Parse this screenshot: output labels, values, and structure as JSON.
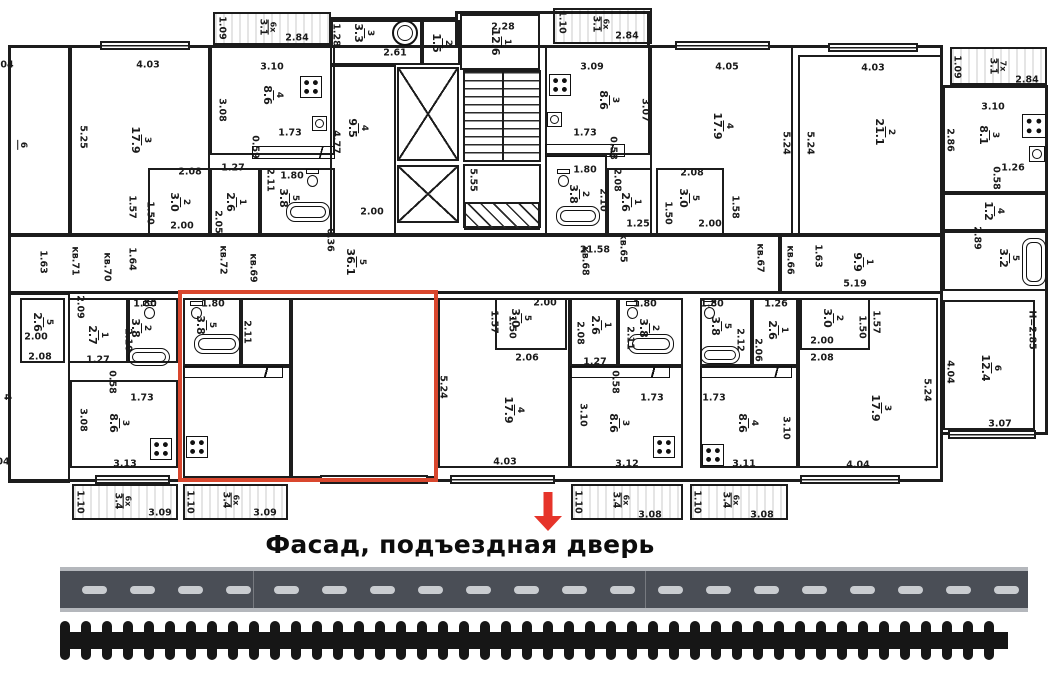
{
  "caption": {
    "text": "Фасад, подъездная дверь"
  },
  "colors": {
    "wall": "#1c1c1c",
    "highlight": "#d9472e",
    "arrow": "#e6342a",
    "road_bg": "#4a4e56",
    "road_edge": "#b4b7bc",
    "road_dash": "#c9ccd0",
    "rail": "#161616"
  },
  "plan": {
    "rooms": [
      [
        8,
        45,
        62,
        190,
        "6",
        "",
        22,
        145
      ],
      [
        70,
        45,
        140,
        190,
        "3",
        "17.9"
      ],
      [
        210,
        45,
        125,
        110,
        "4",
        "8.6",
        272,
        95
      ],
      [
        148,
        168,
        62,
        67,
        "2",
        "3.0"
      ],
      [
        210,
        168,
        50,
        67,
        "1",
        "2.6"
      ],
      [
        260,
        168,
        75,
        67,
        "5",
        "3.8",
        288,
        198
      ],
      [
        330,
        20,
        92,
        45,
        "3",
        "3.3",
        363,
        33
      ],
      [
        422,
        20,
        38,
        45,
        "2",
        "1.5"
      ],
      [
        330,
        65,
        66,
        170,
        "4",
        "9.5",
        357,
        128
      ],
      [
        460,
        14,
        80,
        56,
        "1",
        "12.6",
        500,
        42
      ],
      [
        545,
        45,
        105,
        110,
        "3",
        "8.6",
        608,
        100
      ],
      [
        545,
        155,
        62,
        80,
        "2",
        "3.8",
        578,
        194
      ],
      [
        607,
        168,
        45,
        67,
        "1",
        "2.6"
      ],
      [
        656,
        168,
        68,
        67,
        "5",
        "3.0",
        688,
        198
      ],
      [
        650,
        45,
        143,
        190,
        "4",
        "17.9",
        722,
        126
      ],
      [
        798,
        55,
        145,
        180,
        "2",
        "21.1",
        884,
        132
      ],
      [
        943,
        85,
        105,
        108,
        "3",
        "8.1",
        988,
        135
      ],
      [
        943,
        193,
        105,
        38,
        "4",
        "1.2",
        993,
        211
      ],
      [
        943,
        231,
        105,
        60,
        "5",
        "3.2",
        1008,
        258
      ],
      [
        8,
        235,
        772,
        58,
        "5",
        "36.1",
        355,
        262
      ],
      [
        780,
        235,
        163,
        58,
        "1",
        "9.9",
        862,
        262
      ],
      [
        8,
        293,
        62,
        190,
        "",
        ""
      ],
      [
        20,
        298,
        45,
        65,
        "5",
        "2.6",
        42,
        322
      ],
      [
        68,
        298,
        60,
        65,
        "1",
        "2.7",
        97,
        335
      ],
      [
        128,
        298,
        50,
        65,
        "2",
        "3.8",
        140,
        328
      ],
      [
        70,
        380,
        108,
        88,
        "3",
        "8.6",
        118,
        423
      ],
      [
        183,
        298,
        58,
        68,
        "5",
        "3.8",
        205,
        325
      ],
      [
        241,
        298,
        50,
        68,
        "",
        ""
      ],
      [
        183,
        366,
        108,
        112,
        "",
        ""
      ],
      [
        291,
        298,
        145,
        180,
        "",
        ""
      ],
      [
        438,
        298,
        132,
        170,
        "4",
        "17.9",
        513,
        410
      ],
      [
        495,
        298,
        72,
        52,
        "5",
        "3.0",
        520,
        318
      ],
      [
        570,
        298,
        48,
        68,
        "1",
        "2.6",
        600,
        325
      ],
      [
        618,
        298,
        65,
        68,
        "2",
        "3.8",
        648,
        328
      ],
      [
        570,
        366,
        113,
        102,
        "3",
        "8.6",
        618,
        423
      ],
      [
        700,
        298,
        52,
        68,
        "5",
        "3.8",
        720,
        326
      ],
      [
        752,
        298,
        46,
        68,
        "1",
        "2.6",
        777,
        330
      ],
      [
        800,
        298,
        70,
        52,
        "2",
        "3.0",
        832,
        318
      ],
      [
        700,
        366,
        98,
        102,
        "4",
        "8.6",
        747,
        423
      ],
      [
        798,
        298,
        140,
        170,
        "3",
        "17.9",
        880,
        408
      ],
      [
        943,
        300,
        92,
        130,
        "6",
        "12.4",
        990,
        368
      ]
    ],
    "balconies": [
      [
        213,
        12,
        118,
        33,
        "6x",
        "3.1",
        267,
        27
      ],
      [
        553,
        8,
        99,
        36,
        "6x",
        "3.1",
        600,
        24
      ],
      [
        950,
        47,
        97,
        38,
        "7x",
        "3.1",
        997,
        66
      ],
      [
        72,
        484,
        106,
        36,
        "6x",
        "3.4",
        122,
        501
      ],
      [
        183,
        484,
        105,
        36,
        "6x",
        "3.4",
        230,
        500
      ],
      [
        571,
        484,
        112,
        36,
        "6x",
        "3.4",
        620,
        500
      ],
      [
        690,
        484,
        98,
        36,
        "6x",
        "3.4",
        730,
        500
      ]
    ],
    "dims": [
      [
        "04",
        7,
        65,
        0
      ],
      [
        "4.03",
        148,
        65,
        0
      ],
      [
        "5.25",
        83,
        137,
        1
      ],
      [
        "3.10",
        272,
        67,
        0
      ],
      [
        "3.08",
        222,
        110,
        1
      ],
      [
        "1.73",
        290,
        133,
        0
      ],
      [
        "0.59",
        255,
        147,
        1
      ],
      [
        "2.08",
        190,
        172,
        0
      ],
      [
        "1.27",
        233,
        168,
        0
      ],
      [
        "2.11",
        270,
        180,
        1
      ],
      [
        "1.80",
        292,
        176,
        0
      ],
      [
        "1.57",
        132,
        207,
        1
      ],
      [
        "1.50",
        150,
        213,
        1
      ],
      [
        "2.00",
        182,
        226,
        0
      ],
      [
        "2.05",
        218,
        222,
        1
      ],
      [
        "1.09",
        222,
        28,
        1
      ],
      [
        "2.84",
        297,
        38,
        0
      ],
      [
        "1.28",
        336,
        35,
        1
      ],
      [
        "2.61",
        395,
        53,
        0
      ],
      [
        "2.28",
        503,
        27,
        0
      ],
      [
        "1.10",
        562,
        22,
        1
      ],
      [
        "2.84",
        627,
        36,
        0
      ],
      [
        "4.77",
        336,
        142,
        1
      ],
      [
        "2.00",
        372,
        212,
        0
      ],
      [
        "0.36",
        330,
        240,
        1
      ],
      [
        "5.55",
        473,
        180,
        1
      ],
      [
        "3.09",
        592,
        67,
        0
      ],
      [
        "3.07",
        645,
        110,
        1
      ],
      [
        "1.73",
        585,
        133,
        0
      ],
      [
        "0.58",
        613,
        148,
        1
      ],
      [
        "1.80",
        585,
        170,
        0
      ],
      [
        "2.10",
        603,
        200,
        1
      ],
      [
        "2.08",
        617,
        180,
        1
      ],
      [
        "1.25",
        638,
        224,
        0
      ],
      [
        "2.08",
        692,
        173,
        0
      ],
      [
        "1.50",
        668,
        213,
        1
      ],
      [
        "1.58",
        735,
        207,
        1
      ],
      [
        "2.00",
        710,
        224,
        0
      ],
      [
        "4.05",
        727,
        67,
        0
      ],
      [
        "5.24",
        786,
        143,
        1
      ],
      [
        "5.24",
        810,
        143,
        1
      ],
      [
        "4.03",
        873,
        68,
        0
      ],
      [
        "1.09",
        957,
        67,
        1
      ],
      [
        "2.84",
        1027,
        80,
        0
      ],
      [
        "3.10",
        993,
        107,
        0
      ],
      [
        "2.86",
        950,
        140,
        1
      ],
      [
        "1.26",
        1013,
        168,
        0
      ],
      [
        "0.58",
        996,
        178,
        1
      ],
      [
        "2.89",
        977,
        238,
        1
      ],
      [
        "1.63",
        818,
        256,
        1
      ],
      [
        "5.19",
        855,
        284,
        0
      ],
      [
        "1.63",
        43,
        262,
        1
      ],
      [
        "кв.71",
        75,
        261,
        1
      ],
      [
        "1.64",
        132,
        259,
        1
      ],
      [
        "кв.70",
        107,
        267,
        1
      ],
      [
        "кв.72",
        223,
        260,
        1
      ],
      [
        "кв.69",
        253,
        268,
        1
      ],
      [
        "21.58",
        595,
        250,
        0
      ],
      [
        "кв.68",
        585,
        261,
        1
      ],
      [
        "кв.65",
        623,
        248,
        1
      ],
      [
        "кв.67",
        760,
        258,
        1
      ],
      [
        "кв.66",
        790,
        260,
        1
      ],
      [
        "2.09",
        80,
        307,
        1
      ],
      [
        "2.00",
        36,
        337,
        0
      ],
      [
        "2.08",
        40,
        357,
        0
      ],
      [
        "1.27",
        98,
        360,
        0
      ],
      [
        "1.80",
        145,
        304,
        0
      ],
      [
        "2.10",
        128,
        340,
        1
      ],
      [
        "0.58",
        112,
        382,
        1
      ],
      [
        "1.73",
        142,
        398,
        0
      ],
      [
        "3.08",
        83,
        420,
        1
      ],
      [
        "3.13",
        125,
        464,
        0
      ],
      [
        "4",
        7,
        397,
        1
      ],
      [
        "04",
        3,
        462,
        0
      ],
      [
        "1.80",
        213,
        304,
        0
      ],
      [
        "2.11",
        247,
        332,
        1
      ],
      [
        "5.24",
        443,
        387,
        1
      ],
      [
        "2.00",
        545,
        303,
        0
      ],
      [
        "1.57",
        494,
        322,
        1
      ],
      [
        "1.50",
        512,
        327,
        1
      ],
      [
        "2.06",
        527,
        358,
        0
      ],
      [
        "2.08",
        580,
        333,
        1
      ],
      [
        "1.27",
        595,
        362,
        0
      ],
      [
        "1.80",
        645,
        304,
        0
      ],
      [
        "2.11",
        630,
        338,
        1
      ],
      [
        "0.58",
        615,
        382,
        1
      ],
      [
        "1.73",
        652,
        398,
        0
      ],
      [
        "3.10",
        583,
        415,
        1
      ],
      [
        "3.12",
        627,
        464,
        0
      ],
      [
        "4.03",
        505,
        462,
        0
      ],
      [
        "1.80",
        712,
        304,
        0
      ],
      [
        "2.12",
        740,
        340,
        1
      ],
      [
        "1.26",
        776,
        304,
        0
      ],
      [
        "2.06",
        758,
        350,
        1
      ],
      [
        "2.00",
        822,
        341,
        0
      ],
      [
        "2.08",
        822,
        358,
        0
      ],
      [
        "1.57",
        876,
        322,
        1
      ],
      [
        "1.50",
        862,
        327,
        1
      ],
      [
        "1.73",
        714,
        398,
        0
      ],
      [
        "3.10",
        786,
        428,
        1
      ],
      [
        "3.11",
        744,
        464,
        0
      ],
      [
        "4.04",
        858,
        465,
        0
      ],
      [
        "5.24",
        927,
        390,
        1
      ],
      [
        "4.04",
        950,
        372,
        1
      ],
      [
        "3.07",
        1000,
        424,
        0
      ],
      [
        "Н=2.85",
        1032,
        330,
        1
      ],
      [
        "1.10",
        80,
        502,
        1
      ],
      [
        "3.09",
        160,
        513,
        0
      ],
      [
        "1.10",
        190,
        502,
        1
      ],
      [
        "3.09",
        265,
        513,
        0
      ],
      [
        "1.10",
        578,
        502,
        1
      ],
      [
        "3.08",
        650,
        515,
        0
      ],
      [
        "1.10",
        697,
        502,
        1
      ],
      [
        "3.08",
        762,
        515,
        0
      ]
    ],
    "walls": [
      [
        8,
        45,
        935,
        3
      ],
      [
        8,
        45,
        3,
        437
      ],
      [
        8,
        479,
        935,
        3
      ],
      [
        940,
        45,
        3,
        437
      ],
      [
        8,
        233,
        935,
        3
      ],
      [
        8,
        291,
        935,
        3
      ],
      [
        943,
        85,
        105,
        3
      ],
      [
        1045,
        85,
        3,
        350
      ],
      [
        943,
        432,
        102,
        3
      ],
      [
        455,
        11,
        195,
        3
      ],
      [
        455,
        11,
        3,
        34
      ],
      [
        647,
        11,
        3,
        34
      ],
      [
        330,
        17,
        128,
        3
      ],
      [
        330,
        17,
        3,
        28
      ]
    ],
    "windows": [
      [
        100,
        41,
        90
      ],
      [
        675,
        41,
        95
      ],
      [
        828,
        43,
        90
      ],
      [
        95,
        475,
        75
      ],
      [
        320,
        475,
        108
      ],
      [
        450,
        475,
        105
      ],
      [
        800,
        475,
        100
      ],
      [
        948,
        430,
        88
      ]
    ],
    "elevators": [
      [
        397,
        67,
        62,
        94
      ],
      [
        397,
        165,
        62,
        58
      ]
    ],
    "stairs": {
      "main": [
        463,
        70,
        78,
        92
      ],
      "landing": [
        463,
        164,
        78,
        64
      ],
      "under": [
        464,
        202,
        76,
        28
      ]
    },
    "icons": [
      [
        "stove",
        300,
        76,
        22,
        22
      ],
      [
        "stove",
        549,
        74,
        22,
        22
      ],
      [
        "stove",
        1022,
        114,
        24,
        24
      ],
      [
        "stove",
        150,
        438,
        22,
        22
      ],
      [
        "stove",
        186,
        436,
        22,
        22
      ],
      [
        "stove",
        653,
        436,
        22,
        22
      ],
      [
        "stove",
        702,
        444,
        22,
        22
      ],
      [
        "sink",
        312,
        116,
        15,
        15
      ],
      [
        "sink",
        547,
        112,
        15,
        15
      ],
      [
        "sink",
        1029,
        146,
        16,
        16
      ],
      [
        "tub",
        286,
        202,
        44,
        20
      ],
      [
        "tub",
        556,
        206,
        44,
        20
      ],
      [
        "tub",
        128,
        348,
        42,
        18
      ],
      [
        "tub",
        194,
        334,
        46,
        20
      ],
      [
        "tub",
        628,
        334,
        46,
        20
      ],
      [
        "tub",
        700,
        346,
        40,
        18
      ],
      [
        "tub",
        1022,
        238,
        24,
        48
      ],
      [
        "wc",
        306,
        169,
        13,
        18
      ],
      [
        "wc",
        557,
        169,
        13,
        18
      ],
      [
        "wc",
        190,
        301,
        13,
        18
      ],
      [
        "wc",
        626,
        301,
        13,
        18
      ],
      [
        "wc",
        703,
        301,
        13,
        18
      ],
      [
        "wc",
        143,
        301,
        13,
        18
      ],
      [
        "circ",
        392,
        20,
        26,
        26
      ],
      [
        "counter",
        252,
        146,
        83,
        13
      ],
      [
        "counter",
        545,
        144,
        80,
        13
      ],
      [
        "counter",
        183,
        366,
        100,
        12
      ],
      [
        "counter",
        570,
        366,
        100,
        12
      ],
      [
        "counter",
        700,
        366,
        92,
        12
      ]
    ],
    "highlight": [
      178,
      290,
      260,
      192
    ],
    "arrow": {
      "x": 533,
      "y": 492,
      "w": 30,
      "h": 40
    }
  },
  "road": {
    "x": 60,
    "y": 567,
    "w": 968,
    "h": 45,
    "dash_w": 25,
    "dash_h": 8,
    "period": 48,
    "offset": 22,
    "seams": [
      193,
      585
    ]
  },
  "railway": {
    "x": 60,
    "y": 621,
    "w": 948,
    "h": 39,
    "tie_w": 10,
    "period": 21,
    "bar_y": 11,
    "bar_h": 17
  }
}
